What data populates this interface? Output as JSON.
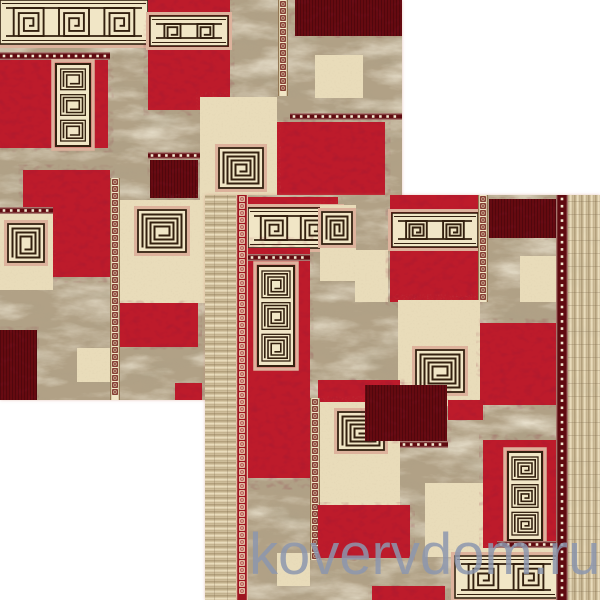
{
  "watermark": {
    "text": "kovervdom.ru",
    "x": 249,
    "y": 526,
    "font_px": 58,
    "color": "rgba(140,150,174,0.85)"
  },
  "palette": {
    "red": "#bd1b2b",
    "dark_red": "#650a10",
    "cream": "#e9dcba",
    "band_bg": "#f1e6c6",
    "marble_base": "#b1a186",
    "pink": "#ddb29c",
    "line": "#33200f",
    "guard_dark": "#5f0a10",
    "guard_red": "#9e1520",
    "dot": "#f2e8d0",
    "chain_brown": "#6b1410",
    "fringe_light": "#e9dcbc",
    "fringe_mid": "#d6c6a3",
    "fringe_dark": "#b3a07c"
  },
  "rugs": [
    {
      "name": "carpet-photo-back",
      "x": 0,
      "y": 0,
      "w": 402,
      "h": 400,
      "patches": [
        {
          "t": "marble",
          "r": [
            0,
            0,
            402,
            400
          ]
        },
        {
          "t": "band",
          "r": [
            0,
            0,
            148,
            44
          ],
          "u": 3
        },
        {
          "t": "dotsH",
          "r": [
            0,
            52,
            110,
            8
          ]
        },
        {
          "t": "red",
          "r": [
            0,
            60,
            108,
            88
          ]
        },
        {
          "t": "spiral3",
          "r": [
            56,
            64,
            34,
            82
          ]
        },
        {
          "t": "red",
          "r": [
            148,
            0,
            82,
            110
          ]
        },
        {
          "t": "band",
          "r": [
            150,
            16,
            78,
            30
          ],
          "u": 2
        },
        {
          "t": "chainV",
          "r": [
            278,
            0,
            10,
            96
          ],
          "v": "brown"
        },
        {
          "t": "darkred",
          "r": [
            295,
            0,
            107,
            36
          ]
        },
        {
          "t": "cream",
          "r": [
            315,
            55,
            48,
            43
          ]
        },
        {
          "t": "dotsH",
          "r": [
            290,
            113,
            112,
            7
          ]
        },
        {
          "t": "red",
          "r": [
            277,
            122,
            108,
            83
          ]
        },
        {
          "t": "dotsH",
          "r": [
            148,
            152,
            60,
            7
          ]
        },
        {
          "t": "darkred",
          "r": [
            150,
            160,
            48,
            38
          ]
        },
        {
          "t": "cream",
          "r": [
            200,
            97,
            77,
            103
          ]
        },
        {
          "t": "spiral",
          "r": [
            219,
            148,
            44,
            40
          ]
        },
        {
          "t": "red",
          "r": [
            23,
            170,
            87,
            107
          ]
        },
        {
          "t": "chainV",
          "r": [
            110,
            178,
            10,
            222
          ],
          "v": "brown"
        },
        {
          "t": "dotsH",
          "r": [
            0,
            207,
            53,
            7
          ]
        },
        {
          "t": "cream",
          "r": [
            0,
            214,
            53,
            76
          ]
        },
        {
          "t": "spiral",
          "r": [
            8,
            224,
            36,
            38
          ]
        },
        {
          "t": "cream",
          "r": [
            120,
            200,
            87,
            103
          ]
        },
        {
          "t": "spiral",
          "r": [
            138,
            210,
            48,
            42
          ]
        },
        {
          "t": "darkred",
          "r": [
            0,
            330,
            37,
            70
          ]
        },
        {
          "t": "red",
          "r": [
            120,
            303,
            78,
            44
          ]
        },
        {
          "t": "cream",
          "r": [
            77,
            348,
            33,
            34
          ]
        },
        {
          "t": "red",
          "r": [
            175,
            383,
            27,
            17
          ]
        }
      ]
    },
    {
      "name": "carpet-photo-front",
      "x": 205,
      "y": 195,
      "w": 395,
      "h": 405,
      "patches": [
        {
          "t": "marble",
          "r": [
            205,
            195,
            395,
            405
          ]
        },
        {
          "t": "red",
          "r": [
            248,
            197,
            90,
            12
          ]
        },
        {
          "t": "band",
          "r": [
            248,
            208,
            92,
            40
          ],
          "u": 2
        },
        {
          "t": "red",
          "r": [
            247,
            248,
            63,
            230
          ]
        },
        {
          "t": "dotsH",
          "r": [
            248,
            254,
            62,
            7
          ]
        },
        {
          "t": "spiral3",
          "r": [
            258,
            266,
            36,
            100
          ]
        },
        {
          "t": "cream",
          "r": [
            320,
            205,
            36,
            76
          ]
        },
        {
          "t": "spiral",
          "r": [
            322,
            212,
            30,
            32
          ]
        },
        {
          "t": "cream",
          "r": [
            355,
            250,
            33,
            52
          ]
        },
        {
          "t": "red",
          "r": [
            390,
            195,
            88,
            107
          ]
        },
        {
          "t": "band",
          "r": [
            392,
            213,
            86,
            34
          ],
          "u": 2
        },
        {
          "t": "chainV",
          "r": [
            478,
            195,
            10,
            107
          ],
          "v": "brown"
        },
        {
          "t": "darkred",
          "r": [
            489,
            199,
            68,
            39
          ]
        },
        {
          "t": "cream",
          "r": [
            520,
            256,
            37,
            46
          ]
        },
        {
          "t": "cream",
          "r": [
            398,
            300,
            82,
            106
          ]
        },
        {
          "t": "spiral",
          "r": [
            416,
            350,
            48,
            42
          ]
        },
        {
          "t": "red",
          "r": [
            480,
            323,
            77,
            82
          ]
        },
        {
          "t": "red",
          "r": [
            318,
            380,
            82,
            22
          ]
        },
        {
          "t": "chainV",
          "r": [
            310,
            398,
            10,
            162
          ],
          "v": "brown"
        },
        {
          "t": "cream",
          "r": [
            320,
            402,
            80,
            103
          ]
        },
        {
          "t": "spiral",
          "r": [
            338,
            412,
            46,
            38
          ]
        },
        {
          "t": "darkred",
          "r": [
            365,
            385,
            82,
            56
          ]
        },
        {
          "t": "dotsH",
          "r": [
            400,
            441,
            48,
            7
          ]
        },
        {
          "t": "red",
          "r": [
            448,
            400,
            35,
            20
          ]
        },
        {
          "t": "red",
          "r": [
            318,
            505,
            92,
            53
          ]
        },
        {
          "t": "cream",
          "r": [
            277,
            553,
            33,
            33
          ]
        },
        {
          "t": "red",
          "r": [
            372,
            586,
            73,
            14
          ]
        },
        {
          "t": "cream",
          "r": [
            425,
            483,
            60,
            74
          ]
        },
        {
          "t": "red",
          "r": [
            483,
            440,
            74,
            108
          ]
        },
        {
          "t": "spiral3",
          "r": [
            508,
            452,
            34,
            88
          ]
        },
        {
          "t": "dotsH",
          "r": [
            497,
            541,
            60,
            7
          ]
        },
        {
          "t": "cream",
          "r": [
            453,
            548,
            104,
            52
          ]
        },
        {
          "t": "band",
          "r": [
            455,
            556,
            102,
            42
          ],
          "u": 2
        },
        {
          "t": "fringe",
          "r": [
            205,
            195,
            31,
            405
          ],
          "dir": "h"
        },
        {
          "t": "chainV",
          "r": [
            236,
            195,
            12,
            405
          ],
          "v": "red"
        },
        {
          "t": "dotsV",
          "r": [
            556,
            195,
            12,
            405
          ]
        },
        {
          "t": "fringe",
          "r": [
            568,
            195,
            32,
            405
          ],
          "dir": "v"
        }
      ]
    }
  ]
}
